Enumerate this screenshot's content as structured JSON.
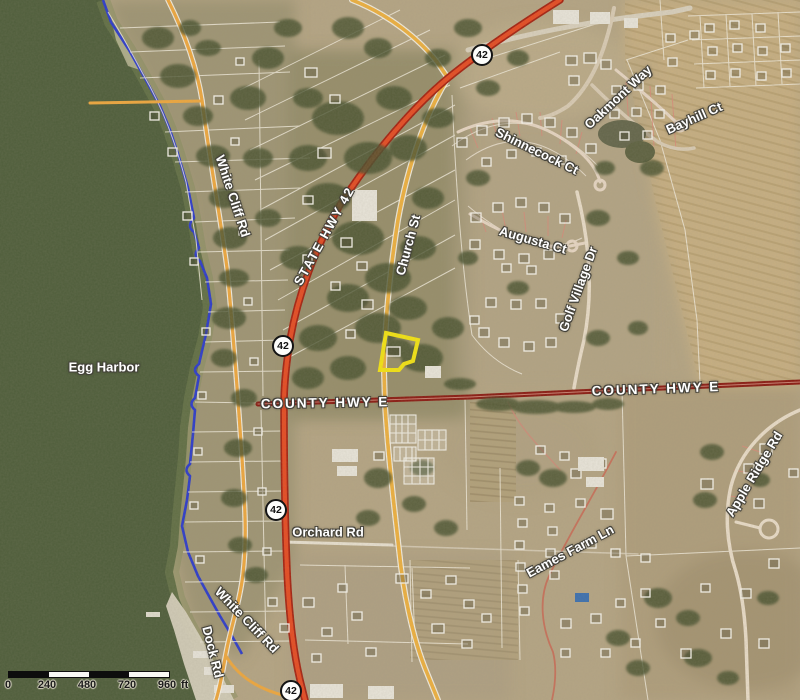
{
  "map": {
    "water_label": "Egg Harbor",
    "roads": [
      {
        "id": "white-cliff-rd-north",
        "text": "White Cliff Rd"
      },
      {
        "id": "state-hwy-42",
        "text": "STATE HWY 42"
      },
      {
        "id": "church-st",
        "text": "Church St"
      },
      {
        "id": "oakmont-way",
        "text": "Oakmont Way"
      },
      {
        "id": "shinnecock-ct",
        "text": "Shinnecock Ct"
      },
      {
        "id": "bayhill-ct",
        "text": "Bayhill Ct"
      },
      {
        "id": "augusta-ct",
        "text": "Augusta Ct"
      },
      {
        "id": "golf-village-dr",
        "text": "Golf Village Dr"
      },
      {
        "id": "county-hwy-e-west",
        "text": "COUNTY HWY E"
      },
      {
        "id": "county-hwy-e-east",
        "text": "COUNTY HWY E"
      },
      {
        "id": "apple-ridge-rd",
        "text": "Apple Ridge Rd"
      },
      {
        "id": "orchard-rd",
        "text": "Orchard Rd"
      },
      {
        "id": "eames-farm-ln",
        "text": "Eames Farm Ln"
      },
      {
        "id": "white-cliff-rd-south",
        "text": "White Cliff Rd"
      },
      {
        "id": "dock-rd",
        "text": "Dock Rd"
      }
    ],
    "shields": [
      "42",
      "42",
      "42",
      "42"
    ],
    "scale_bar": {
      "ticks": [
        "0",
        "240",
        "480",
        "720",
        "960"
      ],
      "unit": "ft"
    },
    "colors": {
      "highlight_parcel": "#f4e411",
      "state_highway": "#e64a21",
      "county_highway": "#8a1810",
      "local_road": "#efa73d",
      "shoreline": "#2b3acc",
      "water": "#4e5d3a"
    }
  }
}
